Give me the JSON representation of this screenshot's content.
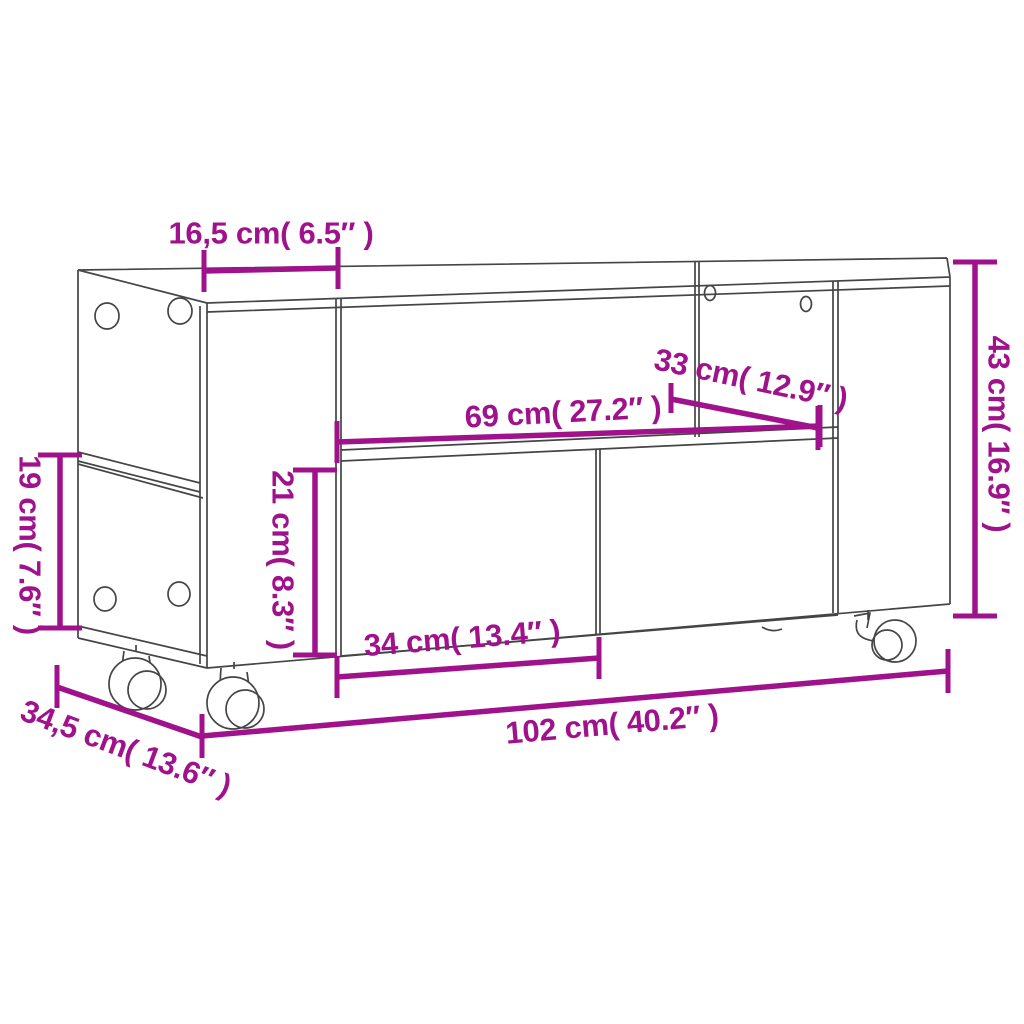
{
  "colors": {
    "dimension_magenta": "#A0128C",
    "drawing_gray": "#454545",
    "background": "#FFFFFF"
  },
  "dimensions": {
    "top_left_section_width": "16,5 cm( 6.5″ )",
    "compartment_depth": "33 cm( 12.9″ )",
    "compartment_width": "69 cm( 27.2″ )",
    "overall_height": "43 cm( 16.9″ )",
    "side_shelf_height": "19 cm( 7.6″ )",
    "front_panel_height": "21 cm( 8.3″ )",
    "door_width": "34 cm( 13.4″ )",
    "overall_width": "102 cm( 40.2″ )",
    "overall_depth": "34,5 cm( 13.6″ )"
  }
}
